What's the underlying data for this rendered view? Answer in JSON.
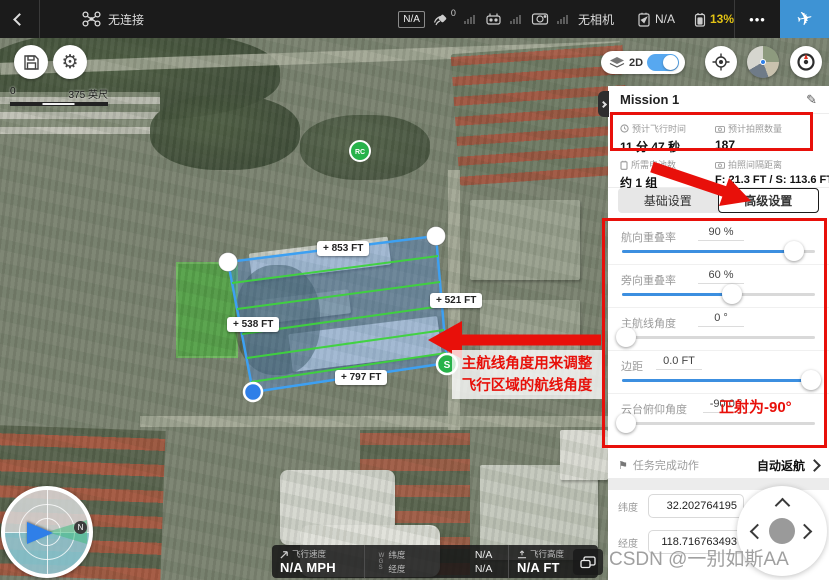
{
  "topbar": {
    "status_text": "无连接",
    "gps_badge": "N/A",
    "gps_count": "0",
    "camera_status": "无相机",
    "aircraft_battery": "N/A",
    "rc_battery": "13%",
    "more_label": "•••"
  },
  "map": {
    "scale_start": "0",
    "scale_end": "375 英尺",
    "mode_label": "2D",
    "rc_marker": "RC",
    "start_marker": "S",
    "edge_labels": {
      "top": "+ 853 FT",
      "right": "+ 521 FT",
      "left": "+ 538 FT",
      "bottom": "+ 797 FT"
    }
  },
  "panel": {
    "title": "Mission 1",
    "stats": [
      {
        "label": "预计飞行时间",
        "value": "11 分 47 秒"
      },
      {
        "label": "预计拍照数量",
        "value": "187"
      },
      {
        "label": "所需电池数",
        "value": "约 1 组"
      },
      {
        "label": "拍照间隔距离",
        "value": "F: 21.3 FT / S: 113.6 FT"
      }
    ],
    "tabs": [
      {
        "label": "基础设置"
      },
      {
        "label": "高级设置"
      }
    ],
    "settings": [
      {
        "label": "航向重叠率",
        "value": "90 %",
        "pct": 89
      },
      {
        "label": "旁向重叠率",
        "value": "60 %",
        "pct": 57
      },
      {
        "label": "主航线角度",
        "value": "0 °",
        "pct": 2
      },
      {
        "label": "边距",
        "value": "0.0 FT",
        "pct": 98
      },
      {
        "label": "云台俯仰角度",
        "value": "-90.0 °",
        "pct": 2
      }
    ],
    "finish_action": {
      "label": "任务完成动作",
      "value": "自动返航"
    },
    "coords": [
      {
        "label": "纬度",
        "value": "32.202764195"
      },
      {
        "label": "经度",
        "value": "118.716763493"
      }
    ]
  },
  "telemetry": {
    "speed_label": "飞行速度",
    "speed_value": "N/A MPH",
    "wgs_letters": [
      "W",
      "G",
      "S"
    ],
    "lat_label": "纬度",
    "lat_value": "N/A",
    "lon_label": "经度",
    "lon_value": "N/A",
    "alt_label": "飞行高度",
    "alt_value": "N/A FT"
  },
  "annotations": {
    "route_note_line1": "主航线角度用来调整",
    "route_note_line2": "飞行区域的航线角度",
    "ortho_note": "正射为-90°"
  },
  "watermark": "CSDN @一别如斯AA",
  "colors": {
    "accent_blue": "#3c8fe0",
    "annotation_red": "#e8100a",
    "battery_yellow": "#e3c314",
    "polygon_stroke": "#3da0f2",
    "flight_line_green": "#3ed43c"
  }
}
